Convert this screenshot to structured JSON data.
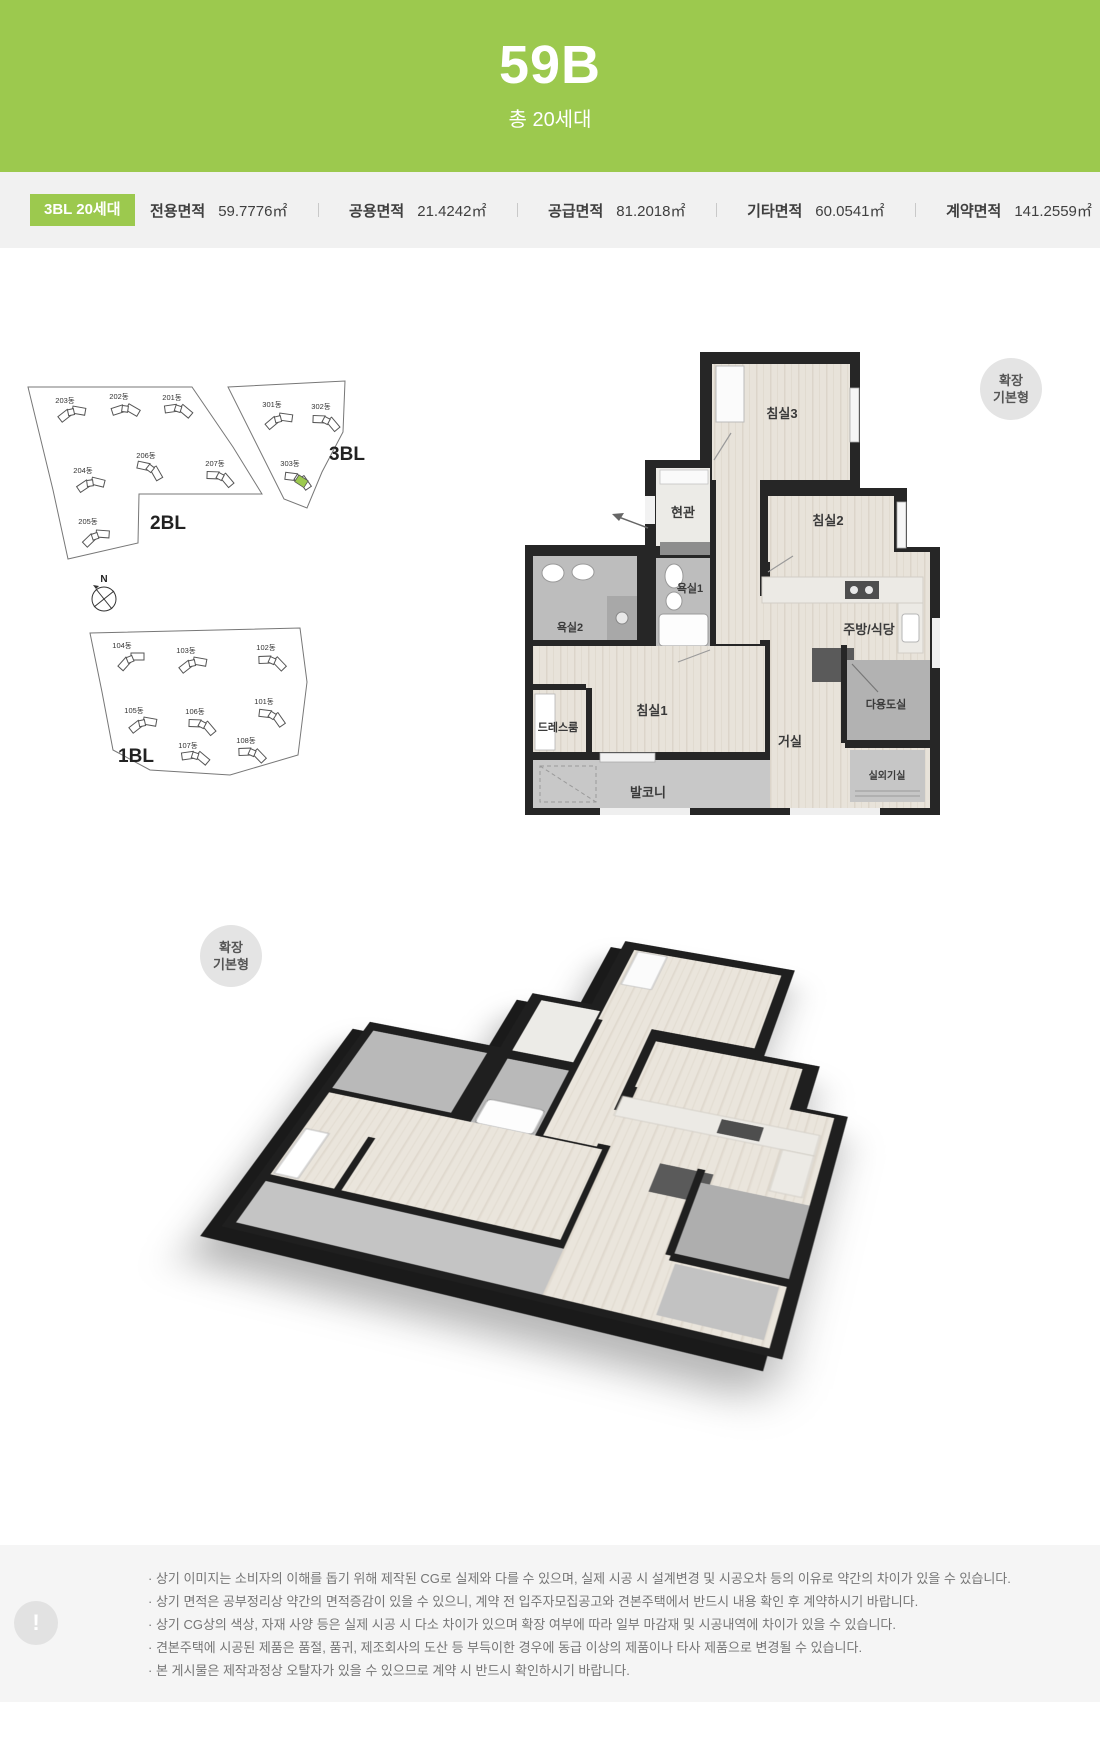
{
  "header": {
    "title": "59B",
    "subtitle": "총 20세대"
  },
  "info_bar": {
    "badge": "3BL 20세대",
    "items": [
      {
        "label": "전용면적",
        "value": "59.7776㎡"
      },
      {
        "label": "공용면적",
        "value": "21.4242㎡"
      },
      {
        "label": "공급면적",
        "value": "81.2018㎡"
      },
      {
        "label": "기타면적",
        "value": "60.0541㎡"
      },
      {
        "label": "계약면적",
        "value": "141.2559㎡"
      }
    ]
  },
  "site_plan": {
    "compass_label": "N",
    "blocks": [
      "2BL",
      "3BL",
      "1BL"
    ],
    "buildings_2bl": [
      "203동",
      "202동",
      "201동",
      "204동",
      "206동",
      "207동",
      "205동"
    ],
    "buildings_3bl": [
      "301동",
      "302동",
      "303동"
    ],
    "buildings_1bl": [
      "104동",
      "103동",
      "102동",
      "105동",
      "106동",
      "101동",
      "107동",
      "108동"
    ],
    "highlight_color": "#9cc94e"
  },
  "floor_plan_2d": {
    "badge_line1": "확장",
    "badge_line2": "기본형",
    "rooms": {
      "bedroom3": "침실3",
      "entrance": "현관",
      "bedroom2": "침실2",
      "bath1": "욕실1",
      "bath2": "욕실2",
      "kitchen": "주방/식당",
      "utility": "다용도실",
      "bedroom1": "침실1",
      "dressroom": "드레스룸",
      "living": "거실",
      "balcony": "발코니",
      "ac_room": "실외기실"
    }
  },
  "floor_plan_3d": {
    "badge_line1": "확장",
    "badge_line2": "기본형"
  },
  "disclaimer": {
    "icon": "!",
    "lines": [
      "· 상기 이미지는 소비자의 이해를 돕기 위해 제작된 CG로 실제와 다를 수 있으며, 실제 시공 시 설계변경 및 시공오차 등의 이유로 약간의 차이가 있을 수 있습니다.",
      "· 상기 면적은 공부정리상 약간의 면적증감이 있을 수 있으니, 계약 전 입주자모집공고와 견본주택에서 반드시 내용 확인 후 계약하시기 바랍니다.",
      "· 상기 CG상의 색상, 자재 사양 등은 실제 시공 시 다소 차이가 있으며 확장 여부에 따라 일부 마감재 및 시공내역에 차이가 있을 수 있습니다.",
      "· 견본주택에 시공된 제품은 품절, 품귀, 제조회사의 도산 등 부득이한 경우에 동급 이상의 제품이나 타사 제품으로 변경될 수 있습니다.",
      "· 본 게시물은 제작과정상 오탈자가 있을 수 있으므로 계약 시 반드시 확인하시기 바랍니다."
    ]
  }
}
